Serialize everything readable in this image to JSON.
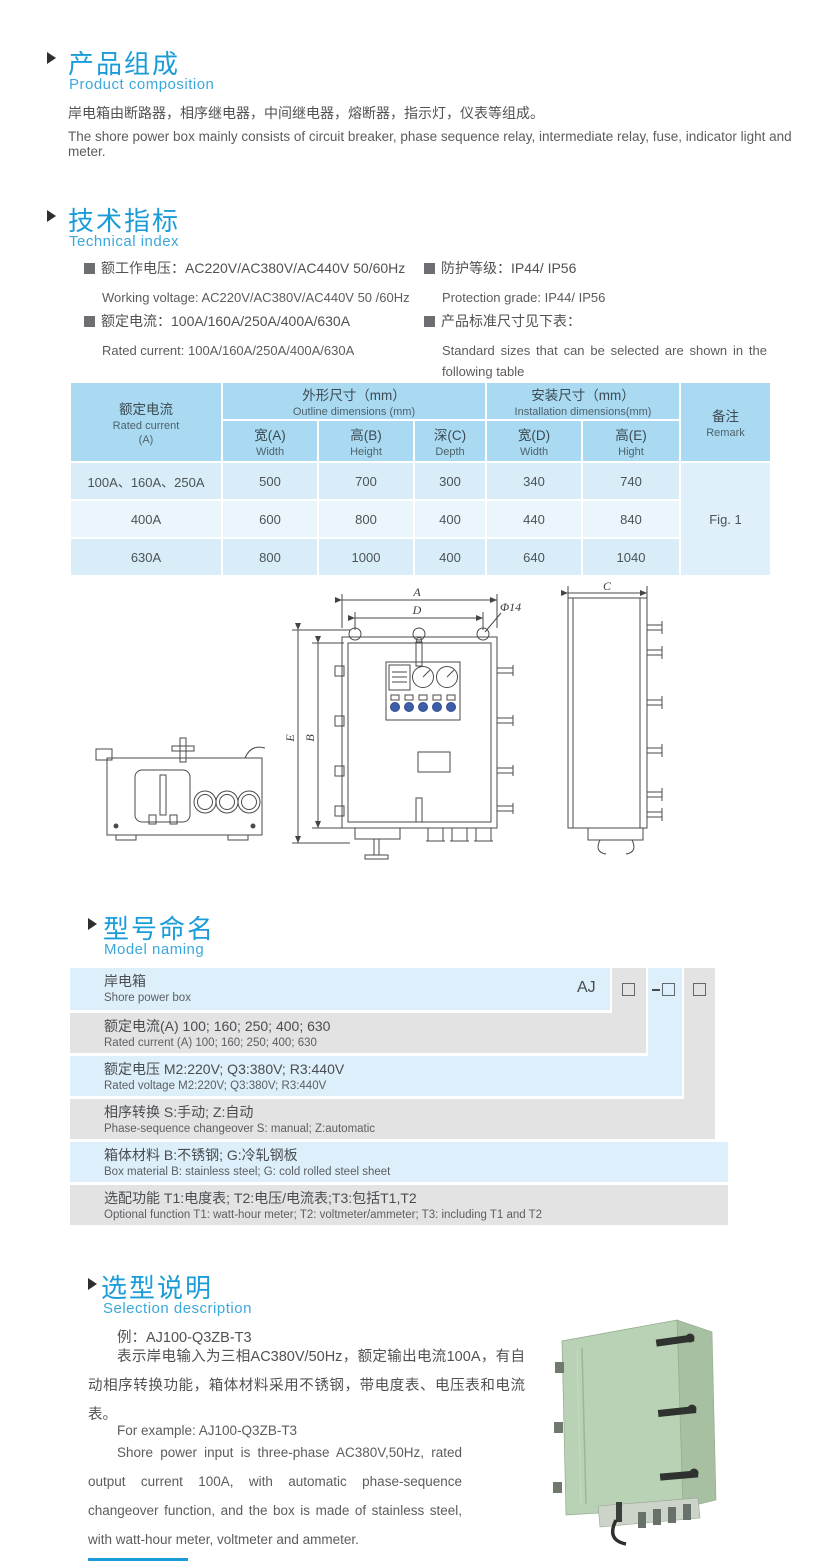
{
  "composition": {
    "title_cn": "产品组成",
    "title_en": "Product  composition",
    "body_cn": "岸电箱由断路器，相序继电器，中间继电器，熔断器，指示灯，仪表等组成。",
    "body_en": "The shore power box mainly consists of circuit breaker, phase sequence relay, intermediate relay, fuse, indicator light and meter."
  },
  "technical": {
    "title_cn": "技术指标",
    "title_en": "Technical index",
    "items": [
      {
        "cn": "额工作电压：AC220V/AC380V/AC440V  50/60Hz",
        "en": "Working voltage: AC220V/AC380V/AC440V 50 /60Hz"
      },
      {
        "cn": "额定电流：100A/160A/250A/400A/630A",
        "en": "Rated current: 100A/160A/250A/400A/630A"
      },
      {
        "cn": "防护等级：IP44/ IP56",
        "en": "Protection grade: IP44/ IP56"
      },
      {
        "cn": "产品标准尺寸见下表：",
        "en": "Standard sizes that can be selected are shown in the following table"
      }
    ]
  },
  "dim_table": {
    "current_cn": "额定电流",
    "current_en": "Rated current",
    "current_unit": "(A)",
    "outline_cn": "外形尺寸（mm）",
    "outline_en": "Outline dimensions (mm)",
    "install_cn": "安装尺寸（mm）",
    "install_en": "Installation dimensions(mm)",
    "remark_cn": "备注",
    "remark_en": "Remark",
    "cols": [
      {
        "cn": "宽(A)",
        "en": "Width"
      },
      {
        "cn": "高(B)",
        "en": "Height"
      },
      {
        "cn": "深(C)",
        "en": "Depth"
      },
      {
        "cn": "宽(D)",
        "en": "Width"
      },
      {
        "cn": "高(E)",
        "en": "Hight"
      }
    ],
    "rows": [
      {
        "current": "100A、160A、250A",
        "w": "500",
        "h": "700",
        "d": "300",
        "iw": "340",
        "ih": "740"
      },
      {
        "current": "400A",
        "w": "600",
        "h": "800",
        "d": "400",
        "iw": "440",
        "ih": "840"
      },
      {
        "current": "630A",
        "w": "800",
        "h": "1000",
        "d": "400",
        "iw": "640",
        "ih": "1040"
      }
    ],
    "remark_value": "Fig. 1"
  },
  "drawing": {
    "dim_a": "A",
    "dim_d": "D",
    "dim_hole": "Φ14",
    "dim_e": "E",
    "dim_b": "B",
    "dim_c": "C"
  },
  "model_naming": {
    "title_cn": "型号命名",
    "title_en": "Model naming",
    "prefix": "AJ",
    "rows": [
      {
        "cn": "岸电箱",
        "en": "Shore power box"
      },
      {
        "cn": "额定电流(A)  100; 160; 250; 400; 630",
        "en": "Rated current (A) 100; 160; 250; 400; 630"
      },
      {
        "cn": "额定电压   M2:220V;  Q3:380V;  R3:440V",
        "en": "Rated voltage   M2:220V;  Q3:380V;  R3:440V"
      },
      {
        "cn": "相序转换  S:手动; Z:自动",
        "en": "Phase-sequence changeover  S: manual;  Z:automatic"
      },
      {
        "cn": "箱体材料    B:不锈钢;  G:冷轧钢板",
        "en": "Box material    B: stainless steel; G: cold rolled steel sheet"
      },
      {
        "cn": "选配功能      T1:电度表;  T2:电压/电流表;T3:包括T1,T2",
        "en": "Optional function   T1: watt-hour meter; T2: voltmeter/ammeter; T3: including T1 and T2"
      }
    ]
  },
  "selection": {
    "title_cn": "选型说明",
    "title_en": "Selection description",
    "example_cn": "例：AJ100-Q3ZB-T3",
    "body_cn": "表示岸电输入为三相AC380V/50Hz，额定输出电流100A，有自动相序转换功能，箱体材料采用不锈钢，带电度表、电压表和电流表。",
    "example_en": "For example: AJ100-Q3ZB-T3",
    "body_en": "Shore power input is three-phase AC380V,50Hz, rated output current 100A, with automatic phase-sequence changeover function, and the box is made of stainless steel, with watt-hour meter, voltmeter and ammeter."
  }
}
